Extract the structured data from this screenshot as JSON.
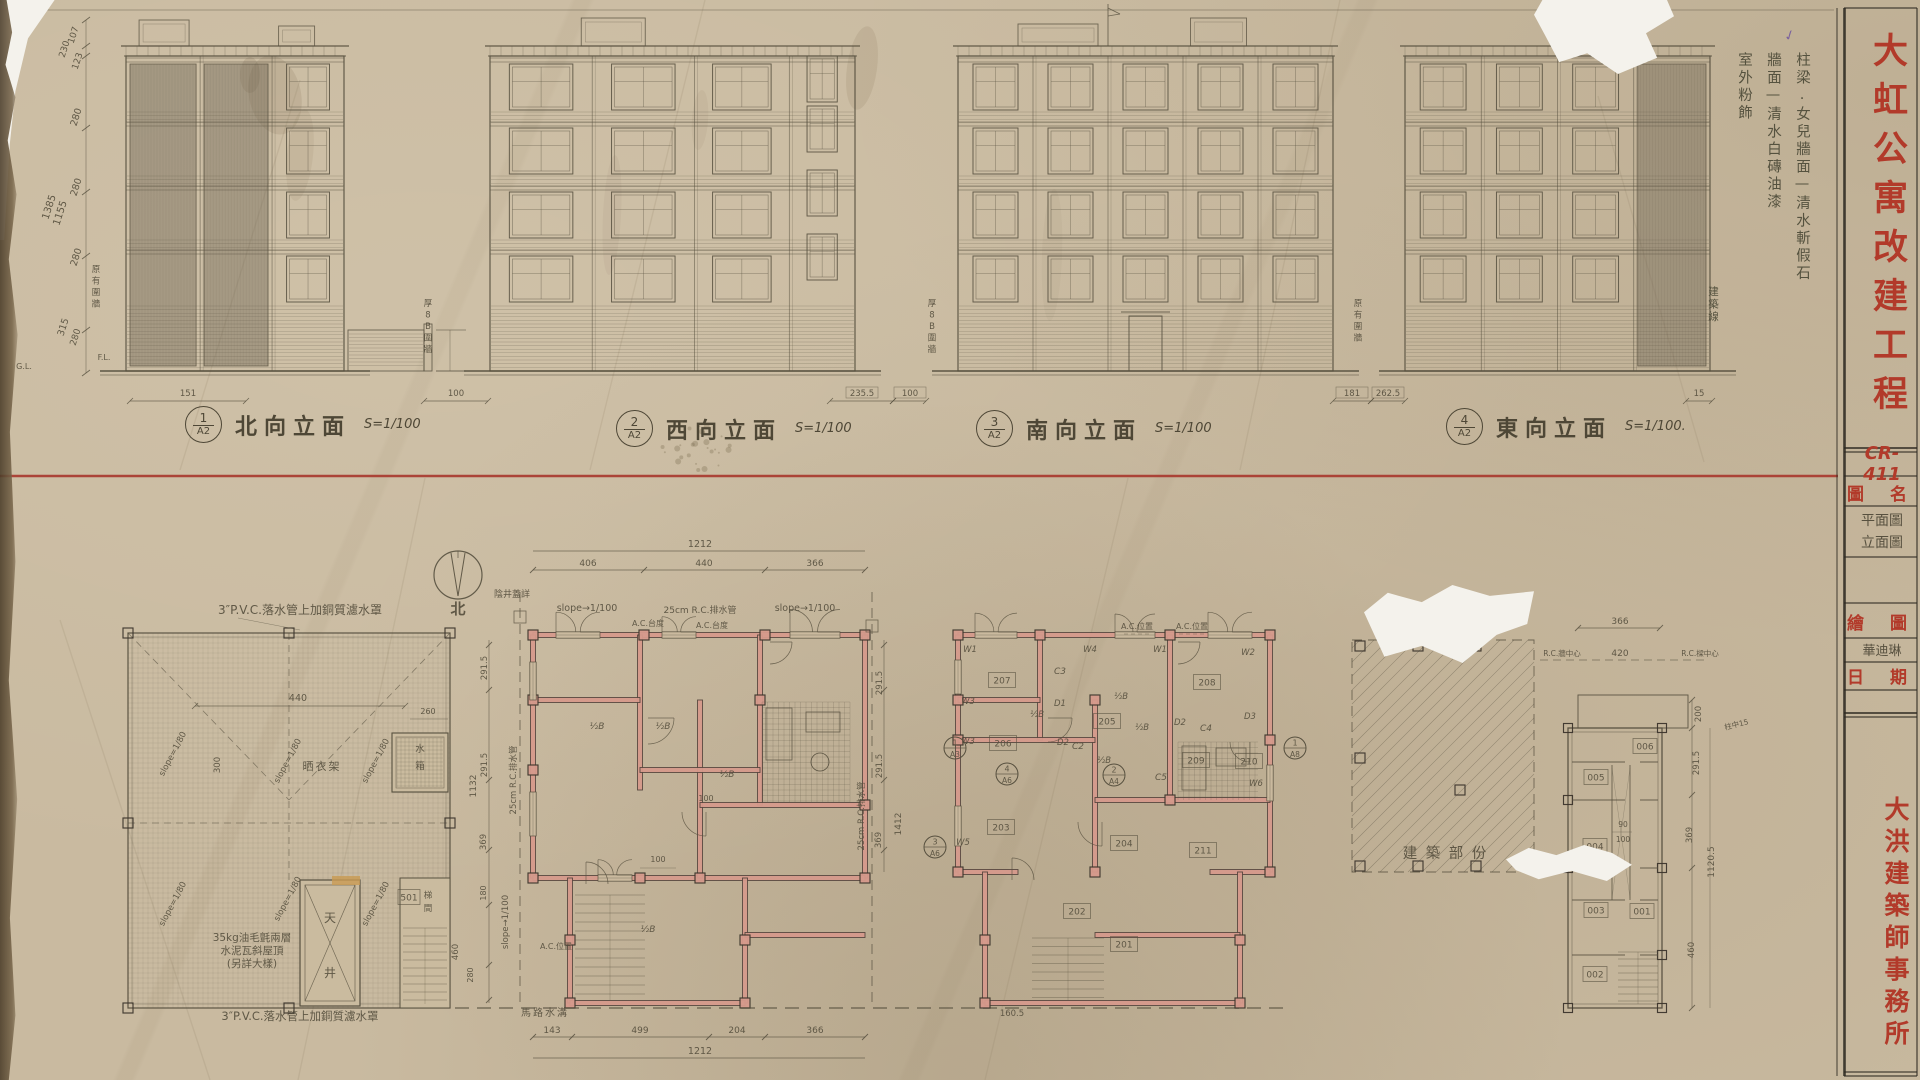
{
  "sheet": {
    "project_title": "大虹公寓改建工程",
    "firm_name": "大洪建築師事務所",
    "drawing_no": "CR-411",
    "title_block": {
      "drawing_name_label": "圖 名",
      "drawing_name_line1": "平面圖",
      "drawing_name_line2": "立面圖",
      "drafter_label": "繪 圖",
      "drafter_name": "華迪琳",
      "date_label": "日 期"
    }
  },
  "finish_notes": {
    "column1": "柱梁.女兒牆面—清水斬假石",
    "column2": "牆面—清水白磚油漆",
    "column3": "室外粉飾"
  },
  "elevations": {
    "items": [
      {
        "ref_no": "1",
        "ref_sheet": "A2",
        "title": "北向立面",
        "scale": "S=1/100"
      },
      {
        "ref_no": "2",
        "ref_sheet": "A2",
        "title": "西向立面",
        "scale": "S=1/100"
      },
      {
        "ref_no": "3",
        "ref_sheet": "A2",
        "title": "南向立面",
        "scale": "S=1/100"
      },
      {
        "ref_no": "4",
        "ref_sheet": "A2",
        "title": "東向立面",
        "scale": "S=1/100."
      }
    ],
    "left_dims": [
      "107",
      "230",
      "123",
      "280",
      "280",
      "280",
      "315",
      "280"
    ],
    "left_totals": [
      "1385",
      "1155"
    ],
    "ground_dims": [
      "151",
      "100",
      "235.5",
      "100",
      "181",
      "262.5",
      "15"
    ],
    "wall_labels": [
      "原有圍牆",
      "厚8B圍牆",
      "厚8B圍牆",
      "原有圍牆"
    ],
    "building_line_label": "建築線",
    "level_labels": [
      "F.L.",
      "G.L."
    ]
  },
  "compass": {
    "north_label": "北"
  },
  "roof_plan": {
    "top_note": "3″P.V.C.落水管上加銅質濾水罩",
    "bottom_note_lines": [
      "35kg油毛氈兩層",
      "水泥瓦斜屋頂",
      "(另詳大樣)"
    ],
    "bottom_note2": "3″P.V.C.落水管上加銅質濾水罩",
    "slope_label": "slope=1/80",
    "labels": {
      "water_tank": "水箱",
      "light_well": "天井",
      "stair": "梯間",
      "drying_rack": "晒衣架",
      "room_tag": "501"
    },
    "dims": [
      "440",
      "260",
      "300"
    ]
  },
  "plan_b": {
    "top_total_dim": "1212",
    "top_dims": [
      "406",
      "440",
      "366"
    ],
    "bottom_dims": [
      "143",
      "499",
      "204",
      "366"
    ],
    "bottom_total_dim": "1212",
    "left_dims": [
      "291.5",
      "291.5",
      "369",
      "180",
      "460",
      "280"
    ],
    "left_total": "1132",
    "annotations": {
      "manhole": "陰井蓋詳",
      "slope": "slope→1/100",
      "drain": "25cm R.C.排水管",
      "ac_sill": "A.C.台度",
      "ac_pos": "A.C.位置",
      "road_gutter": "馬路水溝",
      "wall_half": "½B",
      "dim100": "100"
    }
  },
  "plan_c": {
    "rooms": [
      "201",
      "202",
      "203",
      "204",
      "205",
      "206",
      "207",
      "208",
      "209",
      "210",
      "211"
    ],
    "left_dims": [
      "291.5",
      "291.5",
      "369"
    ],
    "left_total": "1412",
    "bottom_dim": "160.5",
    "window_labels": [
      "W1",
      "W2",
      "W3",
      "W4",
      "W5",
      "W6"
    ],
    "door_labels": [
      "D1",
      "D2",
      "D3"
    ],
    "column_labels": [
      "C2",
      "C3",
      "C4",
      "C5"
    ],
    "detail_refs": [
      {
        "no": "1",
        "sheet": "A3"
      },
      {
        "no": "4",
        "sheet": "A6"
      },
      {
        "no": "2",
        "sheet": "A4"
      },
      {
        "no": "3",
        "sheet": "A6"
      },
      {
        "no": "1",
        "sheet": "A8"
      }
    ]
  },
  "existing_block": {
    "label": "建築部份"
  },
  "plan_e": {
    "rooms": [
      "001",
      "002",
      "003",
      "004",
      "005",
      "006"
    ],
    "top_dim": "366",
    "mid_dim": "420",
    "rc_wall_center": "R.C.牆中心",
    "rc_beam_center": "R.C.樑中心",
    "col_center": "柱中15",
    "right_dims": [
      "200",
      "291.5",
      "369",
      "460"
    ],
    "right_total": "1120.5",
    "small_dims": [
      "90",
      "100"
    ]
  },
  "colors": {
    "red_accent": "#b23a2a",
    "pencil": "#57503f",
    "wall_fill": "#d69a8c",
    "paper": "#c9baa0"
  }
}
